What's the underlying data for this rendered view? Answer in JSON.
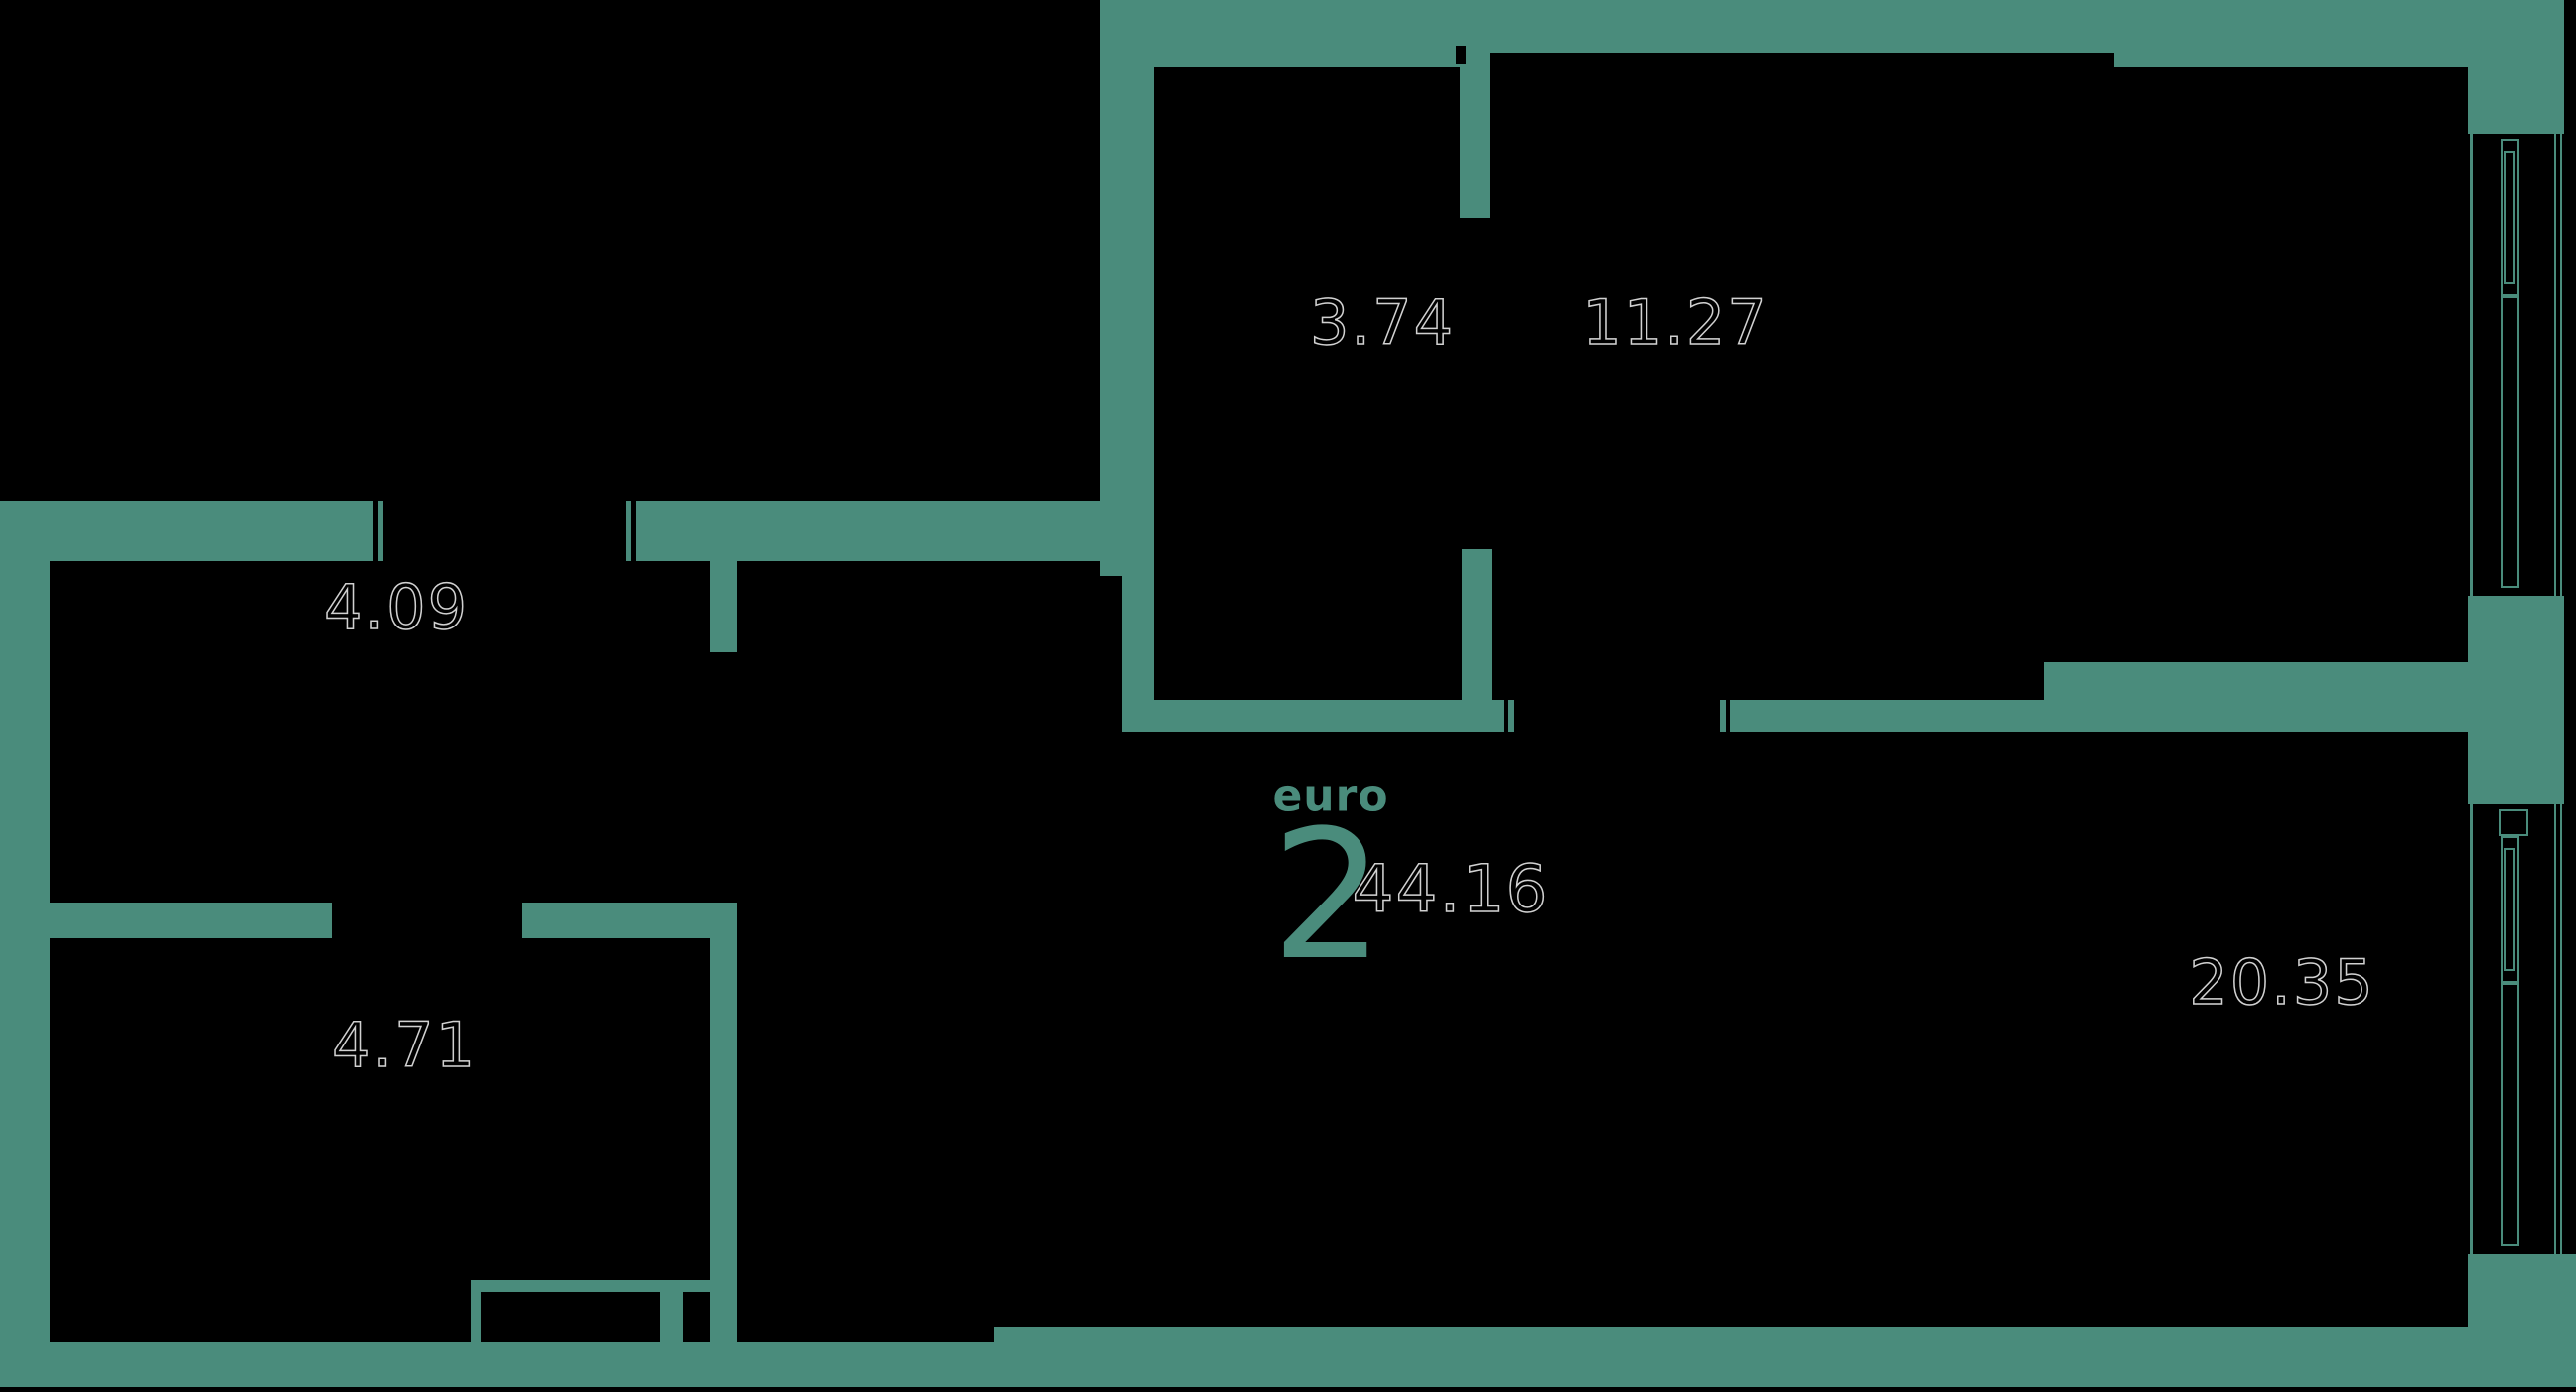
{
  "plan": {
    "title": {
      "type_label": "euro",
      "type_number": "2",
      "total_area": "44.16"
    },
    "rooms": [
      {
        "id": "room-3-74",
        "area": "3.74"
      },
      {
        "id": "room-11-27",
        "area": "11.27"
      },
      {
        "id": "room-4-09",
        "area": "4.09"
      },
      {
        "id": "room-4-71",
        "area": "4.71"
      },
      {
        "id": "room-20-35",
        "area": "20.35"
      }
    ],
    "colors": {
      "wall": "#4A8C7C",
      "background": "#000000",
      "area_outline": "#EEEEEE"
    }
  }
}
